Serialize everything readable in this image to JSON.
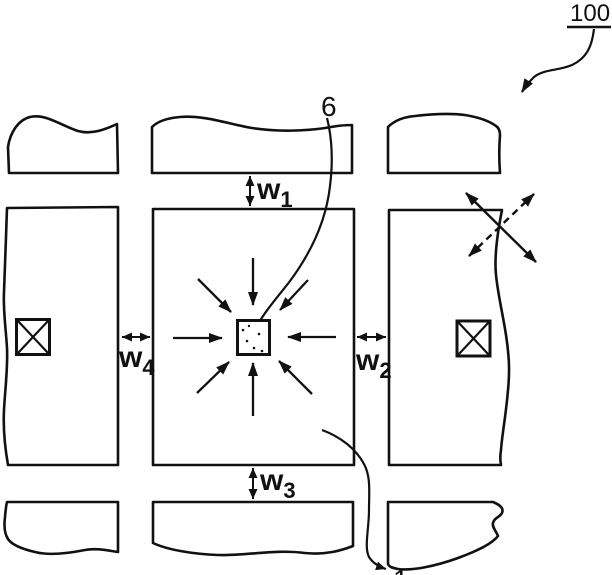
{
  "figure": {
    "type": "patent-drawing",
    "colors": {
      "ink": "#111111",
      "paper": "#ffffff"
    },
    "reference_labels": {
      "assembly": "100",
      "center_feature": "6",
      "pattern_region": "1"
    },
    "width_labels": {
      "w1": {
        "base": "w",
        "sub": "1"
      },
      "w2": {
        "base": "w",
        "sub": "2"
      },
      "w3": {
        "base": "w",
        "sub": "3"
      },
      "w4": {
        "base": "w",
        "sub": "4"
      }
    }
  }
}
